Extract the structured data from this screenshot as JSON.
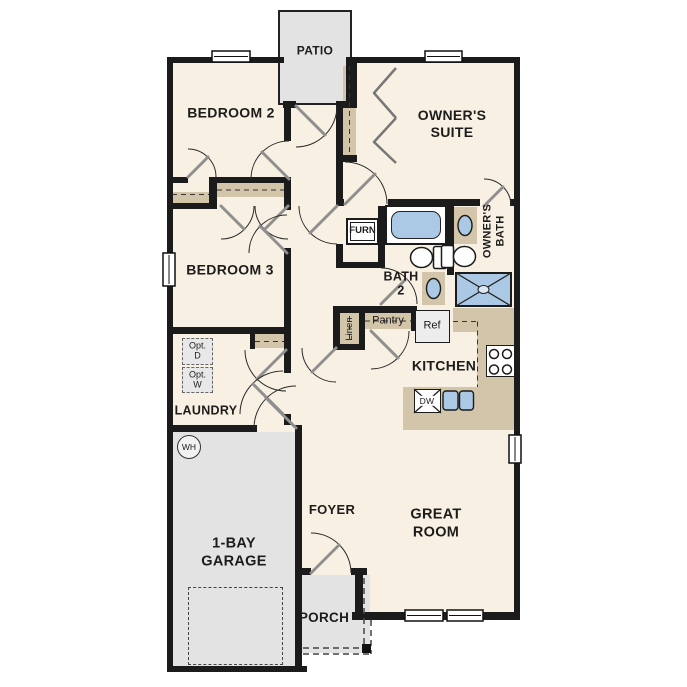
{
  "rooms": {
    "patio": "PATIO",
    "bedroom2": "BEDROOM 2",
    "owners_suite": "OWNER'S\nSUITE",
    "bedroom3": "BEDROOM 3",
    "bath2": "BATH\n2",
    "owners_bath": "OWNER'S\nBATH",
    "kitchen": "KITCHEN",
    "laundry": "LAUNDRY",
    "garage": "1-BAY\nGARAGE",
    "foyer": "FOYER",
    "great_room": "GREAT\nROOM",
    "porch": "PORCH"
  },
  "fixtures": {
    "furnace": "FURN",
    "refrigerator": "Ref",
    "dishwasher": "DW",
    "pantry": "Pantry",
    "linen": "Linen",
    "water_heater": "WH",
    "opt_dryer": "Opt.\nD",
    "opt_washer": "Opt.\nW"
  },
  "colors": {
    "floor": "#f8f0e2",
    "concrete": "#e3e3e3",
    "casework": "#d3c5a9",
    "plumbing": "#abc9e4",
    "wall": "#1b1b1b"
  }
}
